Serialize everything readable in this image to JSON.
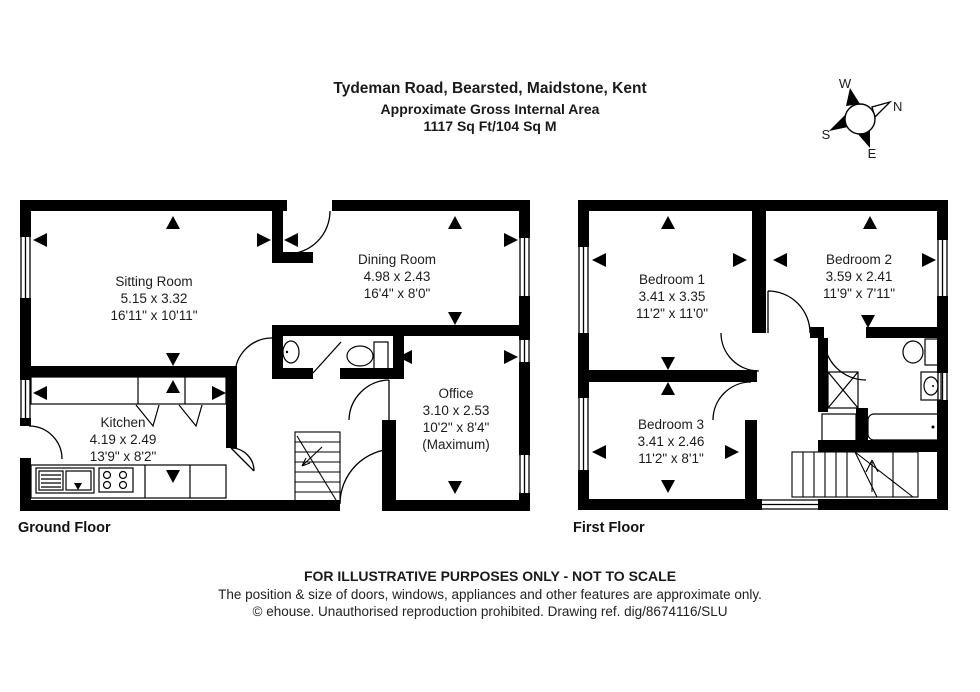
{
  "header": {
    "title": "Tydeman Road, Bearsted, Maidstone, Kent",
    "subtitle": "Approximate Gross Internal Area",
    "area": "1117 Sq Ft/104 Sq M"
  },
  "compass": {
    "n": "N",
    "e": "E",
    "s": "S",
    "w": "W"
  },
  "ground_floor": {
    "label": "Ground Floor",
    "rooms": [
      {
        "name": "Sitting Room",
        "metric": "5.15 x 3.32",
        "imperial": "16'11\" x 10'11\""
      },
      {
        "name": "Dining Room",
        "metric": "4.98 x 2.43",
        "imperial": "16'4\" x 8'0\""
      },
      {
        "name": "Kitchen",
        "metric": "4.19 x 2.49",
        "imperial": "13'9\" x 8'2\""
      },
      {
        "name": "Office",
        "metric": "3.10 x 2.53",
        "imperial": "10'2\" x 8'4\"",
        "note": "(Maximum)"
      }
    ]
  },
  "first_floor": {
    "label": "First Floor",
    "rooms": [
      {
        "name": "Bedroom 1",
        "metric": "3.41 x 3.35",
        "imperial": "11'2\" x 11'0\""
      },
      {
        "name": "Bedroom 2",
        "metric": "3.59 x 2.41",
        "imperial": "11'9\" x 7'11\""
      },
      {
        "name": "Bedroom 3",
        "metric": "3.41 x 2.46",
        "imperial": "11'2\" x 8'1\""
      }
    ]
  },
  "footer": {
    "line1": "FOR ILLUSTRATIVE PURPOSES ONLY - NOT TO SCALE",
    "line2": "The position & size of doors, windows, appliances and other features are approximate only.",
    "line3": "© ehouse. Unauthorised reproduction prohibited. Drawing ref. dig/8674116/SLU"
  },
  "colors": {
    "wall": "#000000",
    "background": "#ffffff",
    "text": "#1a1a1a"
  }
}
